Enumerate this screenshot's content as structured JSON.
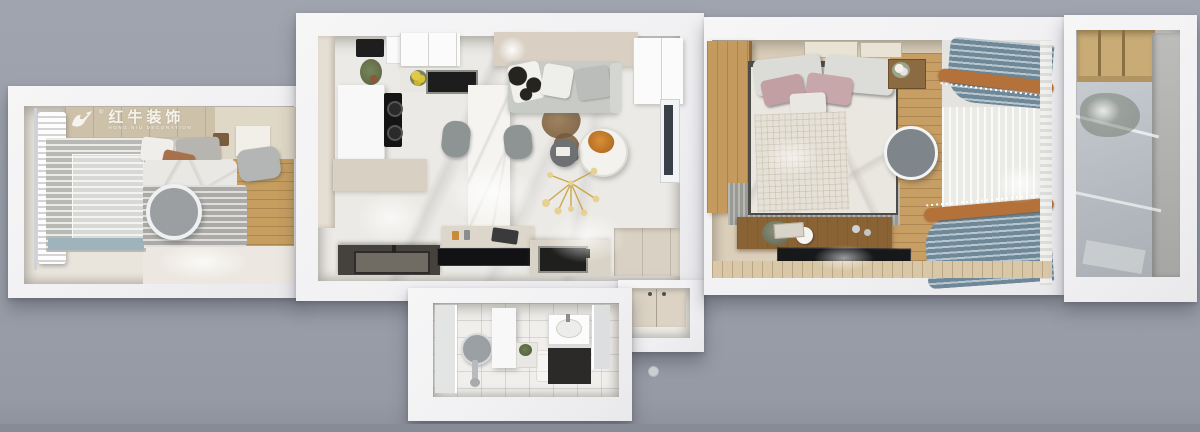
{
  "watermark": {
    "brand_cn": "红牛装饰",
    "brand_en": "HONG NIU DECORATION",
    "registered_mark": "®",
    "logo": "bull-logo-icon"
  },
  "palette": {
    "background_gray": "#9aa0aa",
    "wall_white": "#f2f2f4",
    "floor_marble": "#eceae6",
    "floor_beige": "#e9e5dd",
    "wood_light": "#c79e63",
    "wood_cabinet": "#c9ab76",
    "wood_console_dark": "#8a6335",
    "watermark_band_wood": "#cdc1a9",
    "sofa_gray": "#c8cac6",
    "curtain_blue": "#8ba3b1",
    "curtain_copper": "#b5713a",
    "counter_dark": "#45413c",
    "tv_black": "#17181a",
    "pillow_brown": "#a6714b",
    "pillow_pink": "#c8a7ab",
    "chandelier_gold": "#c9a84c",
    "concrete_gray": "#b0b0ae"
  }
}
